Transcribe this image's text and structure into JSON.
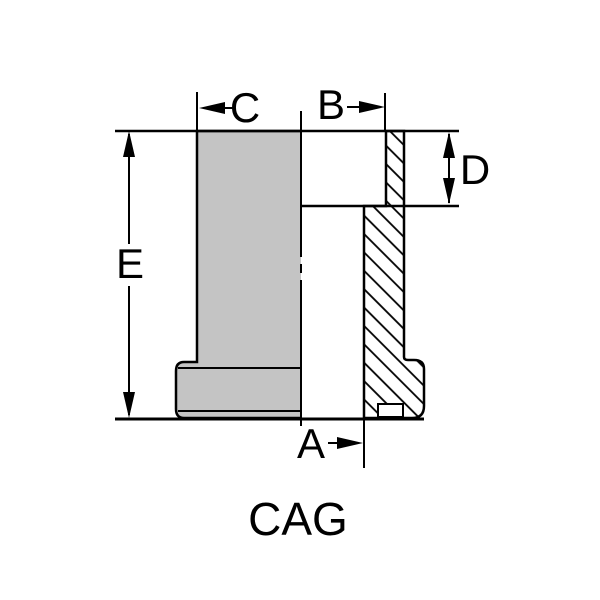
{
  "diagram": {
    "title": "CAG",
    "dimensions": {
      "a": "A",
      "b": "B",
      "c": "C",
      "d": "D",
      "e": "E"
    },
    "colors": {
      "silhouette_fill": "#c4c4c4",
      "line": "#000000",
      "background": "#ffffff"
    }
  }
}
